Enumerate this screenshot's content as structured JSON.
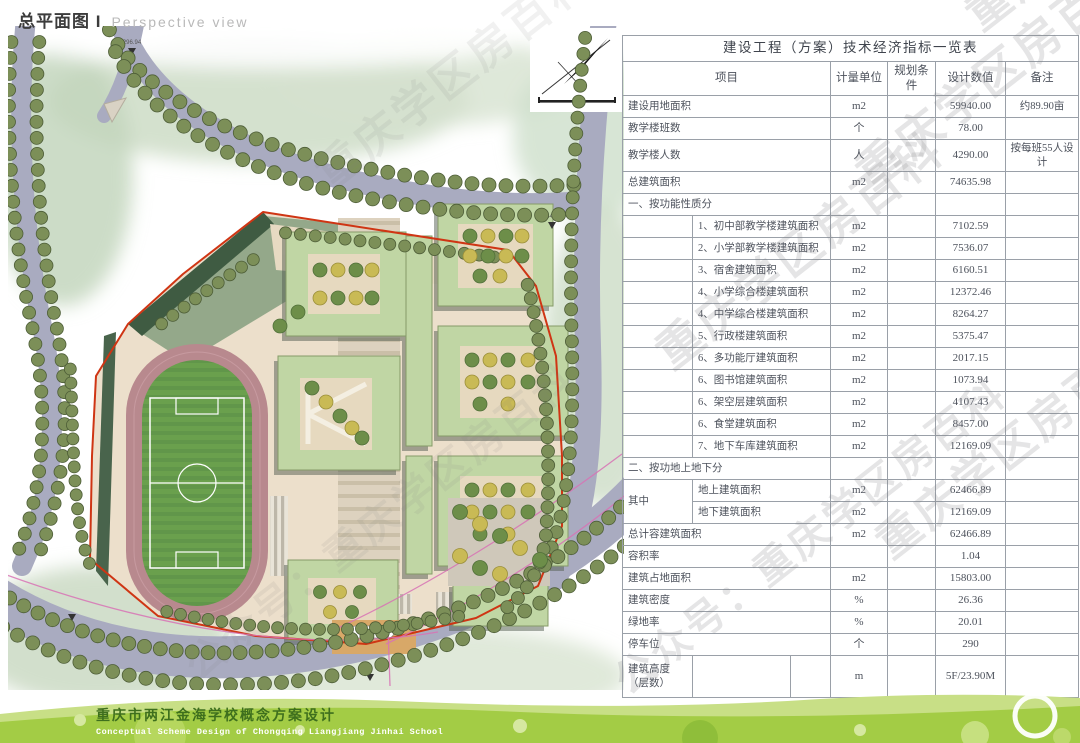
{
  "page": {
    "title_cn": "总平面图 I",
    "title_en": "Perspective view"
  },
  "watermark": {
    "brand": "重庆学区房百科",
    "account": "公众号：重庆学区房百科"
  },
  "map": {
    "elev_296": "296.94",
    "elev_264": "264.08",
    "entrance_level": "244.50"
  },
  "footer": {
    "caption_cn": "重庆市两江金海学校概念方案设计",
    "caption_en": "Conceptual Scheme Design of Chongqing Liangjiang Jinhai School"
  },
  "table": {
    "title": "建设工程（方案）技术经济指标一览表",
    "headers": [
      "项目",
      "计量单位",
      "规划条件",
      "设计数值",
      "备注"
    ],
    "rows": [
      {
        "t": "plain",
        "label": "建设用地面积",
        "unit": "m2",
        "plan": "",
        "value": "59940.00",
        "note": "约89.90亩"
      },
      {
        "t": "plain",
        "label": "教学楼班数",
        "unit": "个",
        "plan": "",
        "value": "78.00",
        "note": ""
      },
      {
        "t": "plain",
        "label": "教学楼人数",
        "unit": "人",
        "plan": "",
        "value": "4290.00",
        "note": "按每班55人设计",
        "h": 32
      },
      {
        "t": "plain",
        "label": "总建筑面积",
        "unit": "m2",
        "plan": "",
        "value": "74635.98",
        "note": ""
      },
      {
        "t": "section",
        "label": "一、按功能性质分"
      },
      {
        "t": "sub",
        "label": "1、初中部教学楼建筑面积",
        "unit": "m2",
        "plan": "",
        "value": "7102.59",
        "note": ""
      },
      {
        "t": "sub",
        "label": "2、小学部教学楼建筑面积",
        "unit": "m2",
        "plan": "",
        "value": "7536.07",
        "note": ""
      },
      {
        "t": "sub",
        "label": "3、宿舍建筑面积",
        "unit": "m2",
        "plan": "",
        "value": "6160.51",
        "note": ""
      },
      {
        "t": "sub",
        "label": "4、小学综合楼建筑面积",
        "unit": "m2",
        "plan": "",
        "value": "12372.46",
        "note": ""
      },
      {
        "t": "sub",
        "label": "4、中学综合楼建筑面积",
        "unit": "m2",
        "plan": "",
        "value": "8264.27",
        "note": ""
      },
      {
        "t": "sub",
        "label": "5、行政楼建筑面积",
        "unit": "m2",
        "plan": "",
        "value": "5375.47",
        "note": ""
      },
      {
        "t": "sub",
        "label": "6、多功能厅建筑面积",
        "unit": "m2",
        "plan": "",
        "value": "2017.15",
        "note": ""
      },
      {
        "t": "sub",
        "label": "6、图书馆建筑面积",
        "unit": "m2",
        "plan": "",
        "value": "1073.94",
        "note": ""
      },
      {
        "t": "sub",
        "label": "6、架空层建筑面积",
        "unit": "m2",
        "plan": "",
        "value": "4107.43",
        "note": ""
      },
      {
        "t": "sub",
        "label": "6、食堂建筑面积",
        "unit": "m2",
        "plan": "",
        "value": "8457.00",
        "note": ""
      },
      {
        "t": "sub",
        "label": "7、地下车库建筑面积",
        "unit": "m2",
        "plan": "",
        "value": "12169.09",
        "note": ""
      },
      {
        "t": "section",
        "label": "二、按功地上地下分"
      },
      {
        "t": "group1",
        "side": "其中",
        "label": "地上建筑面积",
        "unit": "m2",
        "plan": "",
        "value": "62466.89",
        "note": ""
      },
      {
        "t": "group2",
        "label": "地下建筑面积",
        "unit": "m2",
        "plan": "",
        "value": "12169.09",
        "note": ""
      },
      {
        "t": "plain",
        "label": "总计容建筑面积",
        "unit": "m2",
        "plan": "",
        "value": "62466.89",
        "note": ""
      },
      {
        "t": "plain",
        "label": "容积率",
        "unit": "",
        "plan": "",
        "value": "1.04",
        "note": ""
      },
      {
        "t": "plain",
        "label": "建筑占地面积",
        "unit": "m2",
        "plan": "",
        "value": "15803.00",
        "note": ""
      },
      {
        "t": "plain",
        "label": "建筑密度",
        "unit": "%",
        "plan": "",
        "value": "26.36",
        "note": ""
      },
      {
        "t": "plain",
        "label": "绿地率",
        "unit": "%",
        "plan": "",
        "value": "20.01",
        "note": ""
      },
      {
        "t": "plain",
        "label": "停车位",
        "unit": "个",
        "plan": "",
        "value": "290",
        "note": ""
      },
      {
        "t": "tall",
        "label": "建筑高度（层数）",
        "unit": "m",
        "plan": "",
        "value": "5F/23.90M",
        "note": "",
        "h": 42
      }
    ]
  }
}
